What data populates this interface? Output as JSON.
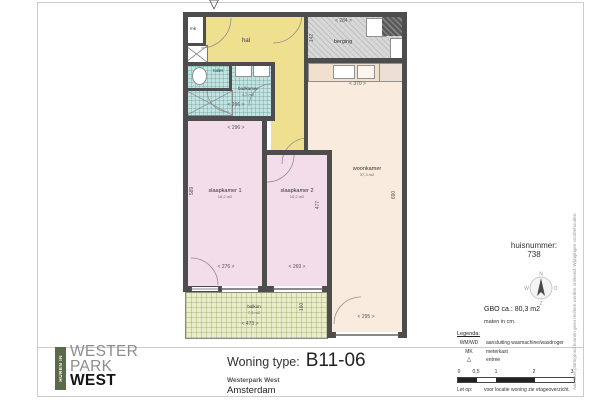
{
  "colors": {
    "hal": "#eee08e",
    "wet": "#c3e2e2",
    "bed": "#f3dde8",
    "living": "#f9ecdf",
    "balcony": "#e9edc9",
    "storage": "#d8d8d8",
    "wall": "#4d4d4d",
    "logo_green": "#5d6a49"
  },
  "plan": {
    "entry_marker": "▽",
    "rooms": {
      "hal": {
        "label": "hal"
      },
      "mk": {
        "label": "mk"
      },
      "berging": {
        "label": "berging"
      },
      "toilet": {
        "label": "toilet"
      },
      "badkamer": {
        "label": "badkamer",
        "area": "4,2 m2"
      },
      "slaapkamer1": {
        "label": "slaapkamer 1",
        "area": "16,2 m2"
      },
      "slaapkamer2": {
        "label": "slaapkamer 2",
        "area": "10,2 m2"
      },
      "woonkamer": {
        "label": "woonkamer",
        "area": "37,3 m2"
      },
      "balkon": {
        "label": "balkon",
        "area": "7,5 m2"
      }
    },
    "dimensions": {
      "berging_width": "< 284 >",
      "berging_depth": "142",
      "kitchen_width": "< 370 >",
      "badkamer_width": "< 296 >",
      "slaapkamer_top_width": "< 296 >",
      "slaapkamer1_depth": "589",
      "slaapkamer1_width": "< 276 >",
      "slaapkamer2_width": "< 269 >",
      "slaapkamer2_depth": "477",
      "woonkamer_depth": "690",
      "woonkamer_width": "< 295 >",
      "balkon_width": "< 473 >",
      "balkon_depth": "160"
    }
  },
  "title_block": {
    "label": "Woning type:",
    "code": "B11-06",
    "project": "Westerpark West",
    "city": "Amsterdam"
  },
  "logo": {
    "tagline": "HUREN IN",
    "line1": "WESTER",
    "line2": "PARK",
    "line3": "WEST"
  },
  "info": {
    "huisnummer_label": "huisnummer:",
    "huisnummer_value": "738",
    "compass": {
      "n": "N",
      "e": "O",
      "s": "Z",
      "w": "W"
    },
    "gbo": "GBO ca.: 80,3 m2",
    "units": "maten in cm.",
    "legend": {
      "title": "Legenda:",
      "items": [
        {
          "key": "WM/WD",
          "desc": "aansluiting wasmachine/wasdroger"
        },
        {
          "key": "MK",
          "desc": "meterkast"
        },
        {
          "key": "△",
          "desc": "entree"
        }
      ]
    },
    "scale_ticks": [
      "0",
      "0,5",
      "1",
      "2",
      "3"
    ],
    "note_label": "Let op:",
    "note_text": "voor locatie woning zie etageoverzicht."
  },
  "disclaimer": "Aan deze plattegrond kunnen geen rechten worden ontleend. Wijzigingen voorbehouden."
}
